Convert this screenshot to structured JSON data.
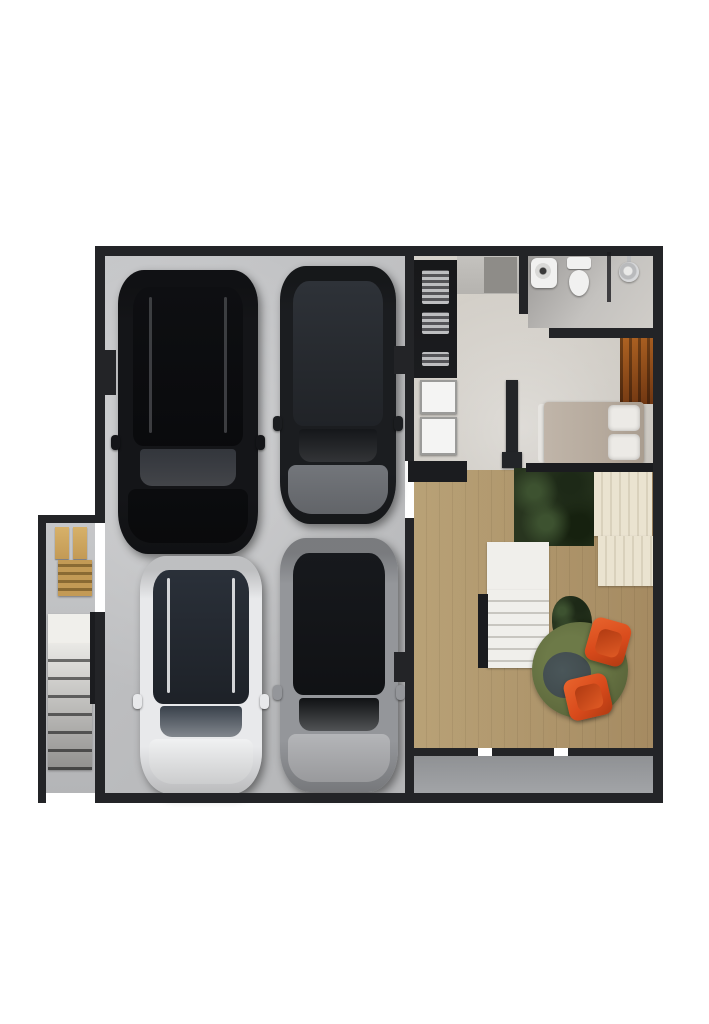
{
  "meta": {
    "type": "architectural-floor-plan-render",
    "view": "top-down 3D render",
    "description": "Garage level floor plan: four parked cars on concrete, side stair annex with bench, entry hall with kitchenette and two white appliances, bathroom with sink, toilet and shower, single bed beside a wood wardrobe, indoor planting bed, interior staircase, round green rug with two orange chairs, and a rear concrete terrace."
  },
  "colors": {
    "wall": "#232427",
    "wallDark": "#1b1c1f",
    "garageFloor": "#c6c7c9",
    "garageFloorDark": "#b4b5b7",
    "hallFloor": "#d6d2cb",
    "bathFloor": "#c4c2bf",
    "woodFloor": "#d9cbae",
    "woodLine": "#cdbfa2",
    "woodDark": "#c2ae8f",
    "terrace": "#a2a4a7",
    "stairWhite": "#f0efeb",
    "stairLine": "#c8c6c0",
    "stair2Light": "#e9e8e5",
    "stair2Dark": "#6f6f6e",
    "bench": "#c39a55",
    "benchDark": "#8a6a33",
    "counterGray": "#b5b3af",
    "counterDark": "#8e8c88",
    "appliance": "#f4f4f3",
    "applianceBorder": "#9b9b99",
    "chrome": "#cfd0d2",
    "fixtureWhite": "#f1f1f0",
    "wardrobe1": "#6e3511",
    "wardrobe2": "#b06423",
    "mattress": "#b5a99c",
    "pillow": "#eceae6",
    "foliage": "#28351f",
    "foliageLight": "#3d5230",
    "cream": "#eae3d0",
    "creamLine": "#d9d1bc",
    "rug": "#5d683c",
    "rugDark": "#39424a",
    "chairOrange": "#d84a1b",
    "chairOrangeDark": "#b03a12",
    "tv": "#232528"
  },
  "rooms": [
    {
      "name": "garage",
      "floor": "concrete"
    },
    {
      "name": "stair-annex",
      "floor": "concrete"
    },
    {
      "name": "entry-hall",
      "floor": "light tile"
    },
    {
      "name": "bathroom",
      "floor": "gray tile"
    },
    {
      "name": "bedroom-nook",
      "floor": "light tile"
    },
    {
      "name": "living-area",
      "floor": "wood planks"
    },
    {
      "name": "terrace",
      "floor": "concrete"
    }
  ],
  "objects": {
    "cars": [
      {
        "name": "black-suv",
        "body": "#141518",
        "roof": "#0e0f12",
        "glass": "#33363c",
        "front": "#0b0c0e",
        "rail": "#45464a"
      },
      {
        "name": "dark-gray-suv",
        "body": "#1b1d20",
        "roof": "#2e3238",
        "glass": "#15171a",
        "front": "#73767b",
        "rail": "#3a3d42"
      },
      {
        "name": "white-suv",
        "body": "#e8e9eb",
        "roof": "#2a3039",
        "glass": "#39414b",
        "front": "#f0f1f2",
        "rail": "#f2f3f4"
      },
      {
        "name": "silver-car",
        "body": "#94969a",
        "roof": "#17191d",
        "glass": "#101214",
        "front": "#b4b5b8",
        "rail": "#6a6c70"
      }
    ],
    "furniture": [
      "kitchenette-shelving",
      "white-appliance-upper",
      "white-appliance-lower",
      "kitchen-counter",
      "bath-sink",
      "toilet",
      "shower-head",
      "wood-wardrobe",
      "single-bed",
      "tv-panel",
      "planting-bed",
      "cream-slat-deck",
      "interior-stairs",
      "annex-stairs",
      "wood-bench",
      "round-green-rug",
      "orange-chair-1",
      "orange-chair-2",
      "potted-plant"
    ]
  }
}
